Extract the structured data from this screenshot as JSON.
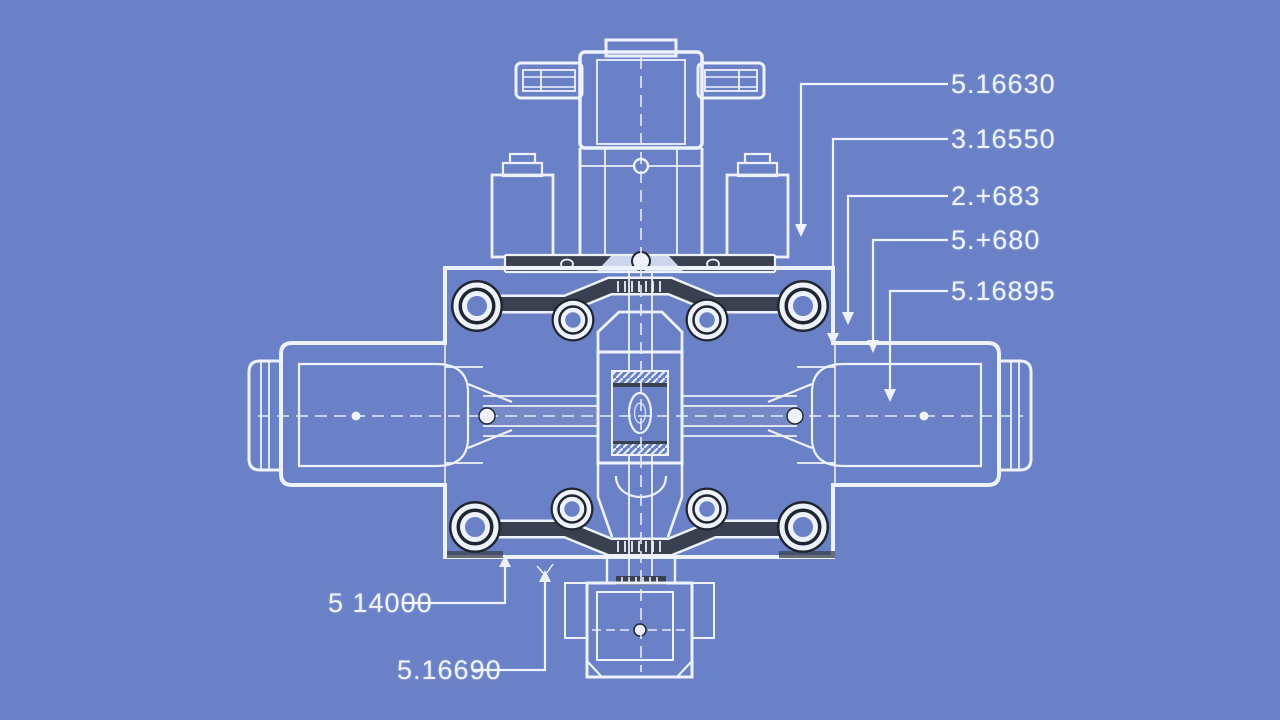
{
  "colors": {
    "background": "#6a81c7",
    "line": "#edf2fb",
    "line_soft": "#e6ecf8",
    "dark": "#39404f",
    "darker": "#21252f",
    "mid": "#8292c2",
    "label_text": "#f1f5fd"
  },
  "callouts": {
    "right": [
      {
        "label": "5.16630"
      },
      {
        "label": "3.16550"
      },
      {
        "label": "2.+683"
      },
      {
        "label": "5.+680"
      },
      {
        "label": "5.16895"
      }
    ],
    "bottom": [
      {
        "label": "5 14000"
      },
      {
        "label": "5.16690"
      }
    ]
  }
}
